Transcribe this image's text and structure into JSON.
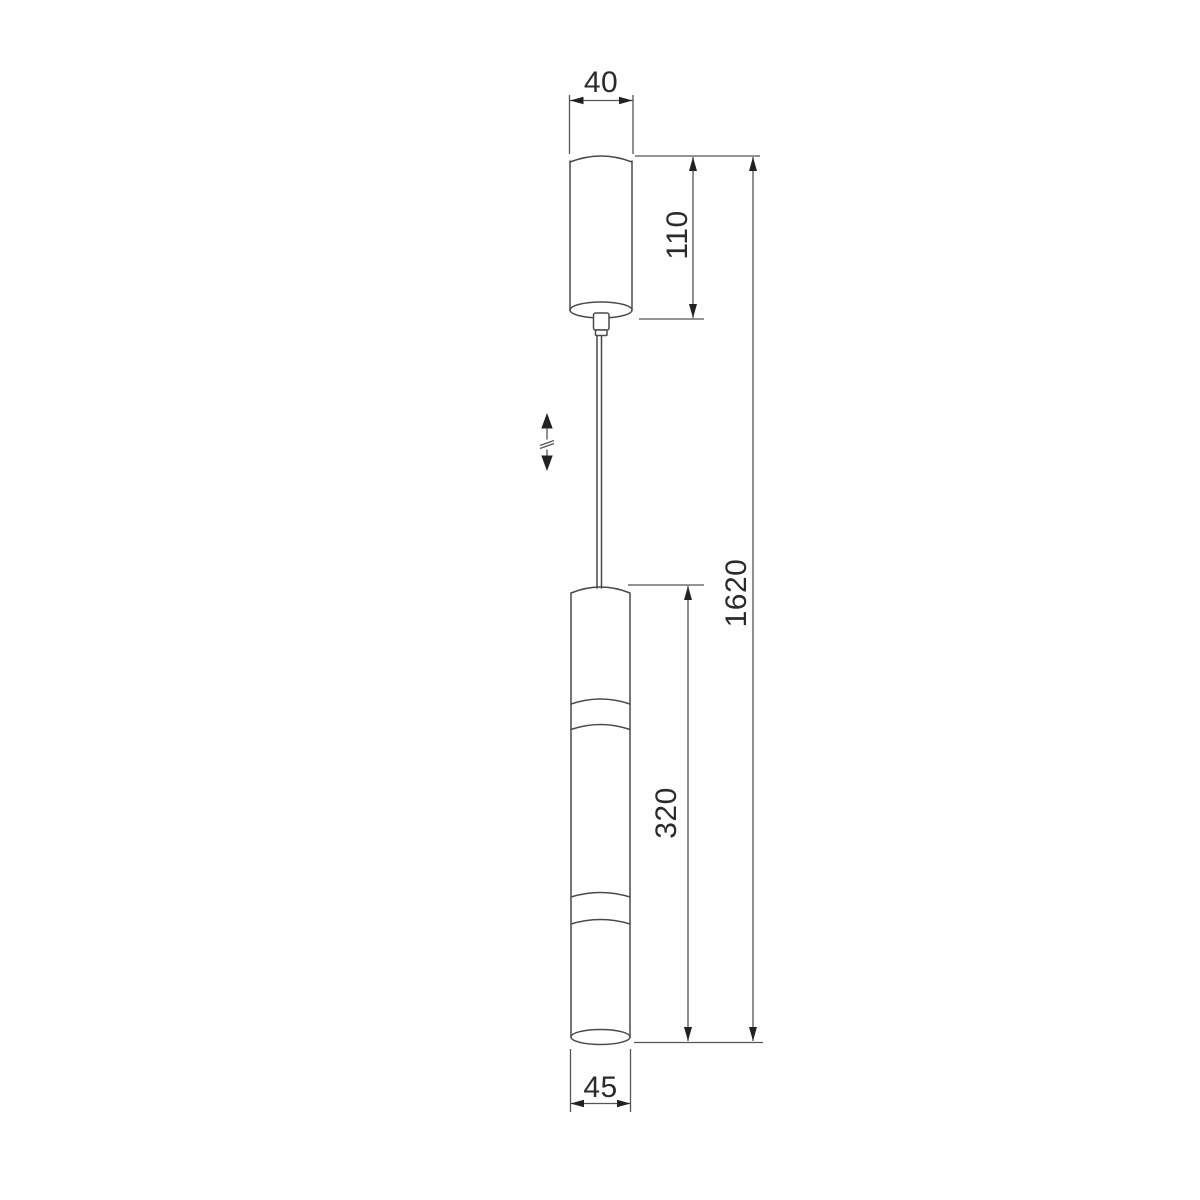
{
  "drawing": {
    "kind": "technical-dimension-drawing",
    "subject": "pendant-light-fixture",
    "dimensions": {
      "canopy_width": {
        "label": "40"
      },
      "canopy_height": {
        "label": "110"
      },
      "overall_height": {
        "label": "1620"
      },
      "body_height": {
        "label": "320"
      },
      "body_width": {
        "label": "45"
      }
    },
    "icons": {
      "height_adjust": "vertical-double-arrow-with-break"
    },
    "colors": {
      "background": "#ffffff",
      "object_line": "#4a4a4a",
      "dim_line": "#555555",
      "arrow": "#222222",
      "text": "#2b2b2b"
    }
  }
}
